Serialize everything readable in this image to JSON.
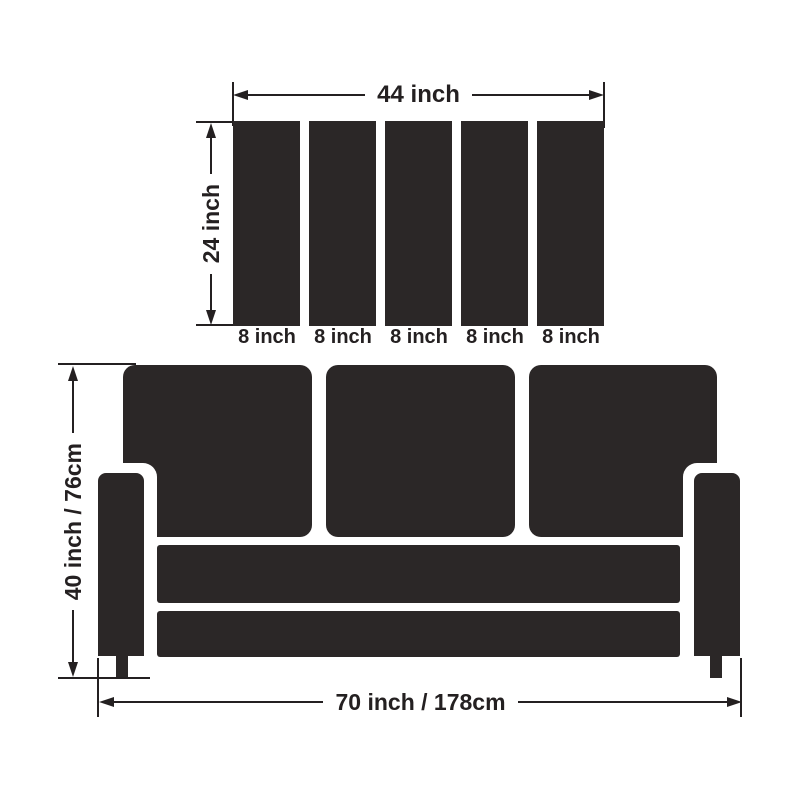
{
  "colors": {
    "shape_fill": "#2b2727",
    "line_and_text": "#242021",
    "background": "#ffffff"
  },
  "panel_diagram": {
    "width_label": "44 inch",
    "height_label": "24 inch",
    "slat_count": 5,
    "slat_labels": [
      "8 inch",
      "8 inch",
      "8 inch",
      "8 inch",
      "8 inch"
    ]
  },
  "sofa_diagram": {
    "height_label": "40 inch / 76cm",
    "width_label": "70 inch / 178cm"
  }
}
